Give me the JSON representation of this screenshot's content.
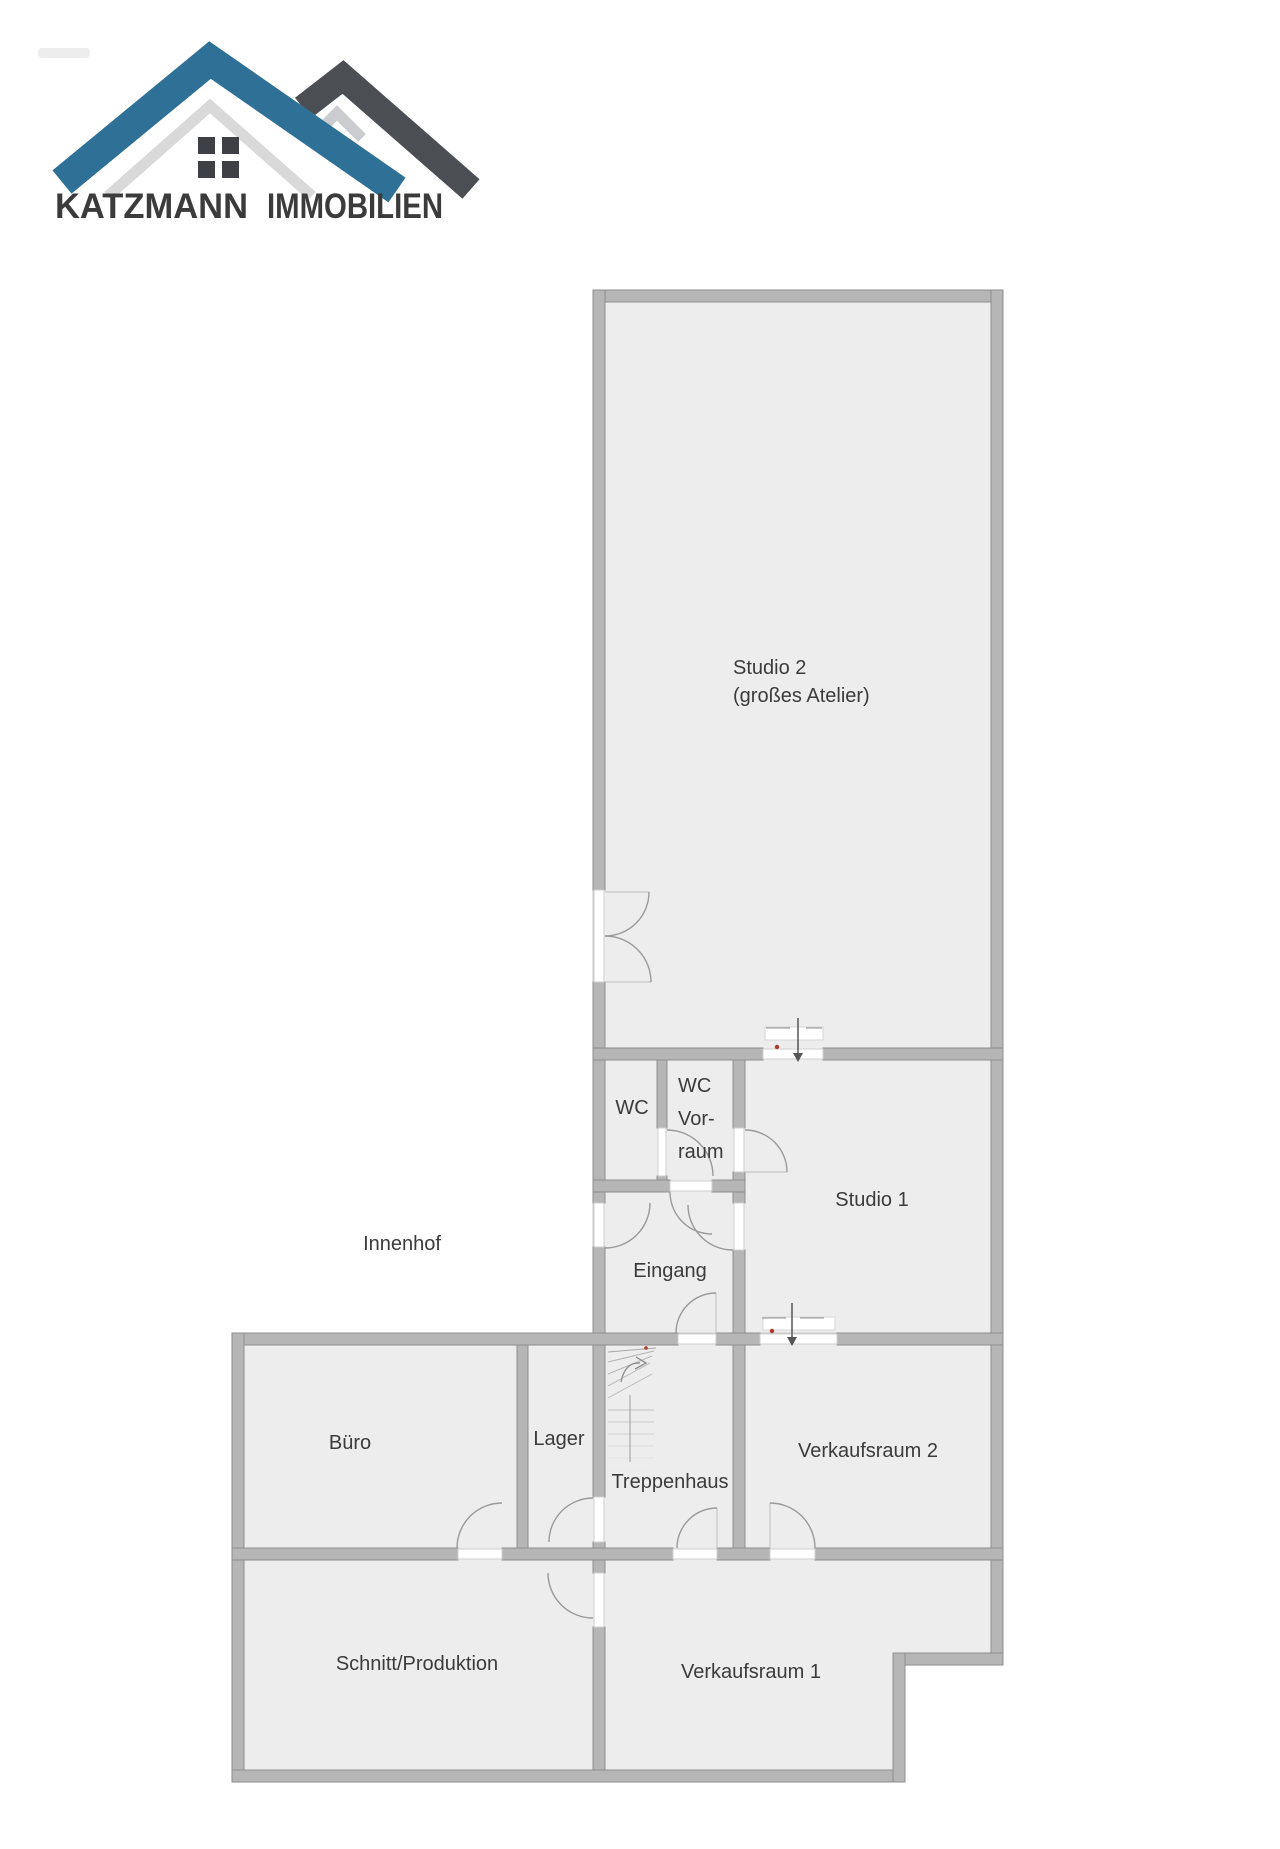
{
  "logo": {
    "brand": "KATZMANN",
    "brand_suffix": "IMMOBILIEN",
    "brand_color": "#2b5a7d",
    "suffix_color": "#acacac",
    "roof_blue": "#2e7096",
    "roof_dark": "#4b4e53"
  },
  "floorplan": {
    "outside_area": {
      "label": "Innenhof"
    },
    "rooms": {
      "studio2": {
        "label": "Studio 2",
        "sublabel": "(großes Atelier)"
      },
      "wc": {
        "label": "WC"
      },
      "wc_vorraum": {
        "line1": "WC",
        "line2": "Vor-",
        "line3": "raum"
      },
      "studio1": {
        "label": "Studio 1"
      },
      "eingang": {
        "label": "Eingang"
      },
      "buero": {
        "label": "Büro"
      },
      "lager": {
        "label": "Lager"
      },
      "treppenhaus": {
        "label": "Treppenhaus"
      },
      "verkaufsraum2": {
        "label": "Verkaufsraum 2"
      },
      "schnitt_produktion": {
        "label": "Schnitt/Produktion"
      },
      "verkaufsraum1": {
        "label": "Verkaufsraum 1"
      }
    },
    "colors": {
      "wall": "#b6b6b6",
      "wall_outline": "#8e8e8e",
      "room_fill": "#ededee",
      "door_arc": "#9a9a9a",
      "label_text": "#3b3b3b",
      "marker_red": "#b03a2a"
    }
  }
}
